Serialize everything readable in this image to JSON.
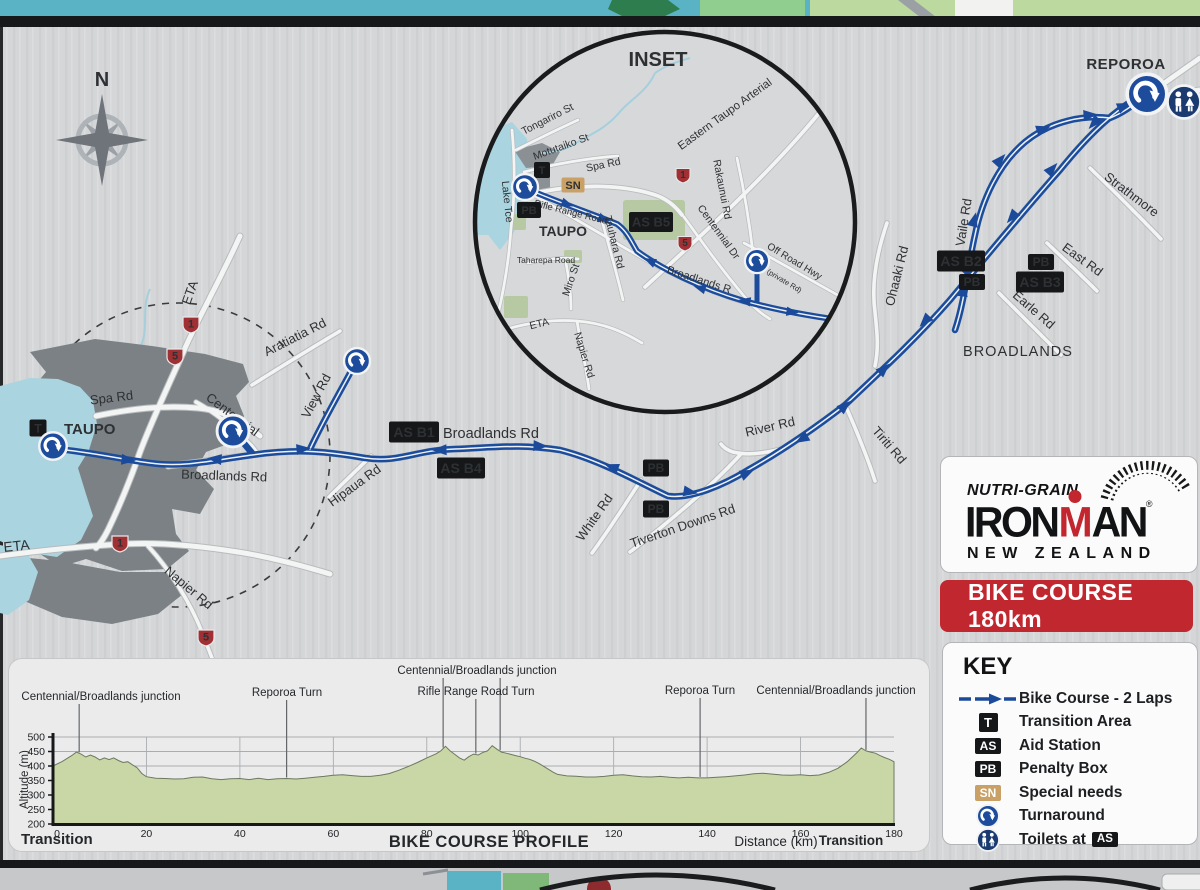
{
  "map": {
    "inset_title": "INSET",
    "compass_n": "N",
    "towns": {
      "taupo": "TAUPO",
      "taupo_inset": "TAUPO",
      "reporoa": "REPOROA",
      "broadlands": "BROADLANDS"
    },
    "roads": {
      "spa": "Spa Rd",
      "centennial": "Centennial",
      "aratiatia": "Aratiatia Rd",
      "view": "View Rd",
      "eta_diag": "ETA",
      "broadlands_1": "Broadlands Rd",
      "broadlands_2": "Broadlands Rd",
      "hipaua": "Hipaua Rd",
      "white": "White Rd",
      "tiverton": "Tiverton Downs Rd",
      "river": "River Rd",
      "tiriti": "Tiriti Rd",
      "ohaaki": "Ohaaki Rd",
      "vaile": "Vaile Rd",
      "east": "East Rd",
      "earle": "Earle Rd",
      "strathmore": "Strathmore",
      "napier": "Napier Rd",
      "eta_west": "ETA"
    },
    "inset_roads": {
      "tongariro": "Tongariro St",
      "motutaiko": "Motutaiko St",
      "spa": "Spa Rd",
      "eastern_taupo_arterial": "Eastern Taupo Arterial",
      "rakaunui": "Rakaunui Rd",
      "lake_tce": "Lake Tce",
      "rifle_range": "Rifle Range Road",
      "tauhara": "Tauhara Rd",
      "taharepa": "Taharepa Road",
      "miro": "Miro St",
      "centennial_dr": "Centennial Dr",
      "broadlands_r": "Broadlands R",
      "off_road_hwy": "Off Road Hwy",
      "private_rd": "(private Rd)",
      "eta": "ETA",
      "napier": "Napier Rd"
    },
    "markers": {
      "t": "T",
      "sn": "SN",
      "pb": "PB",
      "as_b1": "AS B1",
      "as_b2": "AS B2",
      "as_b3": "AS B3",
      "as_b4": "AS B4",
      "as_b5": "AS B5"
    },
    "shield_1": "1",
    "shield_5": "5"
  },
  "logo": {
    "sponsor": "NUTRI-GRAIN",
    "brand_left": "IRON",
    "brand_m": "M",
    "brand_right": "AN",
    "registered": "®",
    "region": "NEW ZEALAND"
  },
  "banner": {
    "text": "BIKE COURSE 180km"
  },
  "key": {
    "title": "KEY",
    "items": [
      {
        "icon": "course-arrow",
        "label": "Bike Course - 2 Laps"
      },
      {
        "icon": "T",
        "label": "Transition Area"
      },
      {
        "icon": "AS",
        "label": "Aid Station"
      },
      {
        "icon": "PB",
        "label": "Penalty Box"
      },
      {
        "icon": "SN",
        "label": "Special needs"
      },
      {
        "icon": "turnaround",
        "label": "Turnaround"
      },
      {
        "icon": "toilets",
        "label": "Toilets at",
        "badge": "AS"
      }
    ]
  },
  "chart_data": {
    "type": "area",
    "title": "BIKE COURSE PROFILE",
    "xlabel": "Distance (km)",
    "ylabel": "Altitude (m)",
    "transition_left": "Transition",
    "transition_right": "Transition",
    "xlim": [
      0,
      180
    ],
    "ylim": [
      200,
      500
    ],
    "xticks": [
      0,
      20,
      40,
      60,
      80,
      100,
      120,
      140,
      160,
      180
    ],
    "yticks": [
      200,
      250,
      300,
      350,
      400,
      450,
      500
    ],
    "grid": true,
    "fill_color": "#c8d7a5",
    "legend_position": "none",
    "annotations": [
      {
        "text": "Centennial/Broadlands junction",
        "km": [
          5.6
        ]
      },
      {
        "text": "Reporoa Turn",
        "km": [
          50
        ]
      },
      {
        "text": "Centennial/Broadlands junction",
        "km": [
          83.5,
          95.7
        ]
      },
      {
        "text": "Rifle Range Road Turn",
        "km": [
          90.5
        ]
      },
      {
        "text": "Reporoa Turn",
        "km": [
          138.5
        ]
      },
      {
        "text": "Centennial/Broadlands junction",
        "km": [
          174
        ]
      }
    ],
    "profile": [
      [
        0,
        400
      ],
      [
        2,
        416
      ],
      [
        4,
        436
      ],
      [
        5,
        448
      ],
      [
        6,
        441
      ],
      [
        7,
        431
      ],
      [
        8,
        438
      ],
      [
        9,
        431
      ],
      [
        10,
        421
      ],
      [
        11,
        428
      ],
      [
        12,
        422
      ],
      [
        13,
        428
      ],
      [
        14,
        419
      ],
      [
        15,
        412
      ],
      [
        16,
        415
      ],
      [
        17,
        404
      ],
      [
        18,
        394
      ],
      [
        19,
        374
      ],
      [
        20,
        363
      ],
      [
        22,
        358
      ],
      [
        24,
        357
      ],
      [
        26,
        355
      ],
      [
        28,
        356
      ],
      [
        30,
        361
      ],
      [
        32,
        362
      ],
      [
        34,
        356
      ],
      [
        36,
        353
      ],
      [
        38,
        356
      ],
      [
        40,
        357
      ],
      [
        42,
        353
      ],
      [
        44,
        358
      ],
      [
        46,
        353
      ],
      [
        48,
        356
      ],
      [
        50,
        357
      ],
      [
        52,
        355
      ],
      [
        54,
        358
      ],
      [
        56,
        361
      ],
      [
        58,
        364
      ],
      [
        60,
        368
      ],
      [
        62,
        370
      ],
      [
        64,
        367
      ],
      [
        66,
        364
      ],
      [
        68,
        364
      ],
      [
        70,
        368
      ],
      [
        72,
        374
      ],
      [
        74,
        385
      ],
      [
        76,
        398
      ],
      [
        78,
        412
      ],
      [
        80,
        428
      ],
      [
        82,
        442
      ],
      [
        83,
        452
      ],
      [
        84,
        468
      ],
      [
        85,
        452
      ],
      [
        86,
        440
      ],
      [
        87,
        428
      ],
      [
        88,
        420
      ],
      [
        89,
        432
      ],
      [
        90,
        441
      ],
      [
        91,
        438
      ],
      [
        92,
        447
      ],
      [
        93,
        452
      ],
      [
        94,
        470
      ],
      [
        95,
        458
      ],
      [
        96,
        448
      ],
      [
        97,
        444
      ],
      [
        98,
        440
      ],
      [
        99,
        436
      ],
      [
        100,
        432
      ],
      [
        101,
        427
      ],
      [
        102,
        423
      ],
      [
        103,
        417
      ],
      [
        104,
        409
      ],
      [
        105,
        399
      ],
      [
        106,
        389
      ],
      [
        107,
        379
      ],
      [
        108,
        371
      ],
      [
        110,
        366
      ],
      [
        112,
        365
      ],
      [
        114,
        362
      ],
      [
        116,
        362
      ],
      [
        118,
        364
      ],
      [
        120,
        368
      ],
      [
        122,
        370
      ],
      [
        124,
        366
      ],
      [
        126,
        363
      ],
      [
        128,
        362
      ],
      [
        130,
        364
      ],
      [
        132,
        361
      ],
      [
        134,
        359
      ],
      [
        136,
        361
      ],
      [
        138,
        359
      ],
      [
        140,
        359
      ],
      [
        142,
        361
      ],
      [
        144,
        363
      ],
      [
        146,
        366
      ],
      [
        148,
        369
      ],
      [
        150,
        373
      ],
      [
        152,
        375
      ],
      [
        154,
        372
      ],
      [
        156,
        369
      ],
      [
        158,
        368
      ],
      [
        160,
        370
      ],
      [
        162,
        367
      ],
      [
        164,
        369
      ],
      [
        166,
        378
      ],
      [
        168,
        392
      ],
      [
        170,
        415
      ],
      [
        172,
        445
      ],
      [
        173,
        462
      ],
      [
        174,
        452
      ],
      [
        175,
        448
      ],
      [
        176,
        444
      ],
      [
        177,
        436
      ],
      [
        178,
        429
      ],
      [
        179,
        423
      ],
      [
        180,
        415
      ]
    ]
  }
}
